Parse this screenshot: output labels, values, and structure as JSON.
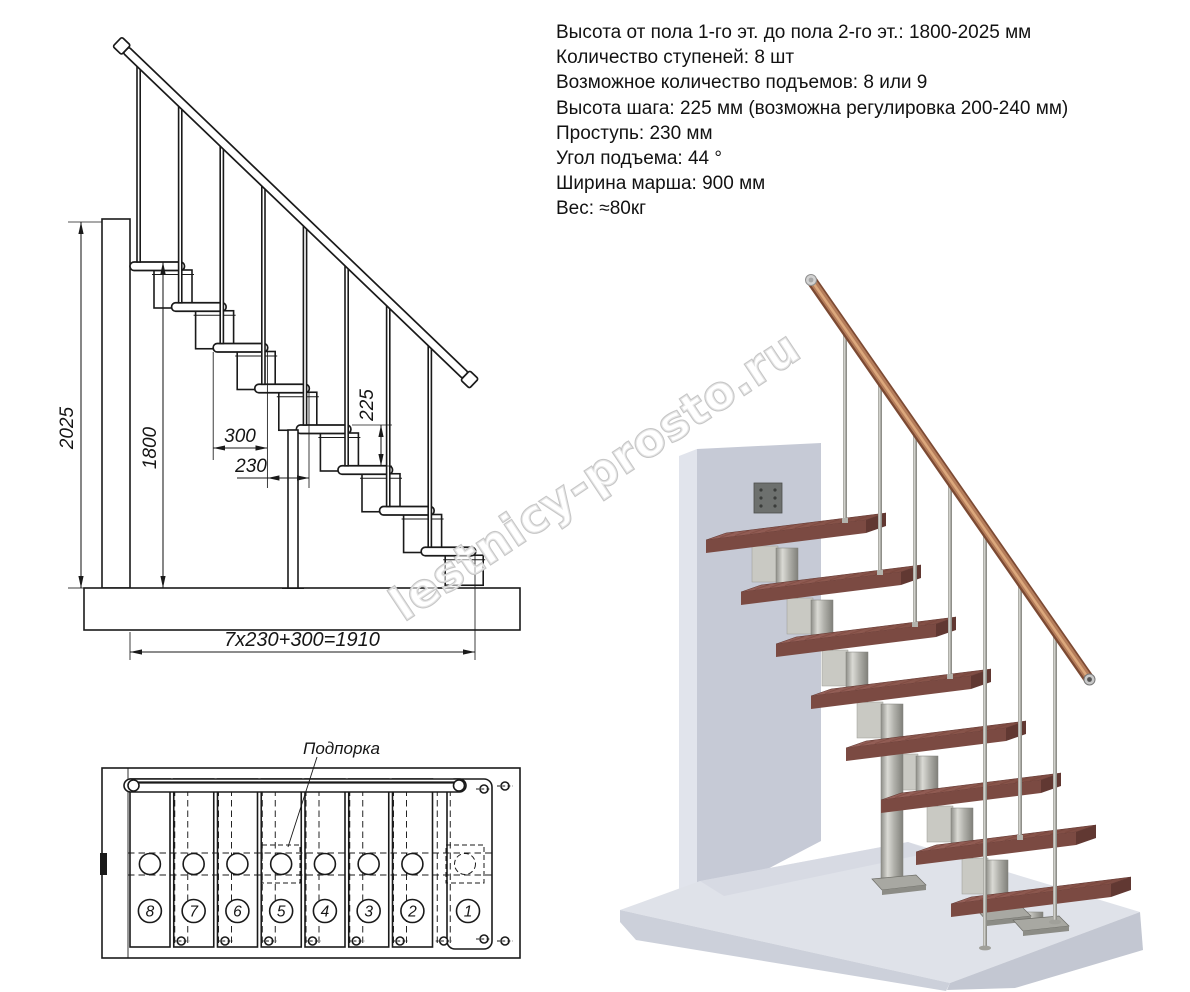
{
  "specs": {
    "lines": [
      "Высота от пола 1-го эт. до пола 2-го эт.: 1800-2025 мм",
      "Количество ступеней: 8 шт",
      "Возможное количество подъемов: 8 или 9",
      "Высота шага: 225 мм (возможна регулировка 200-240 мм)",
      "Проступь: 230 мм",
      "Угол подъема: 44 °",
      "Ширина марша: 900 мм",
      "Вес: ≈80кг"
    ]
  },
  "side_view": {
    "dims": {
      "overall_height": "2025",
      "flight_height": "1800",
      "tread_depth": "300",
      "step_run": "230",
      "step_rise": "225",
      "total_run_formula": "7x230+300=1910"
    }
  },
  "plan_view": {
    "support_label": "Подпорка",
    "step_numbers": [
      "8",
      "7",
      "6",
      "5",
      "4",
      "3",
      "2",
      "1"
    ]
  },
  "watermark": "lestnicy-prosto.ru",
  "colors": {
    "line": "#1a1a1a",
    "wood_top": "#8d574d",
    "wood_front": "#7b4a42",
    "steel": "#b9b9b3",
    "wall": "#c6cad6",
    "floor": "#dfe2e9",
    "handrail_wood": "#b57d5b",
    "watermark_gray": "#c6c6c6"
  }
}
